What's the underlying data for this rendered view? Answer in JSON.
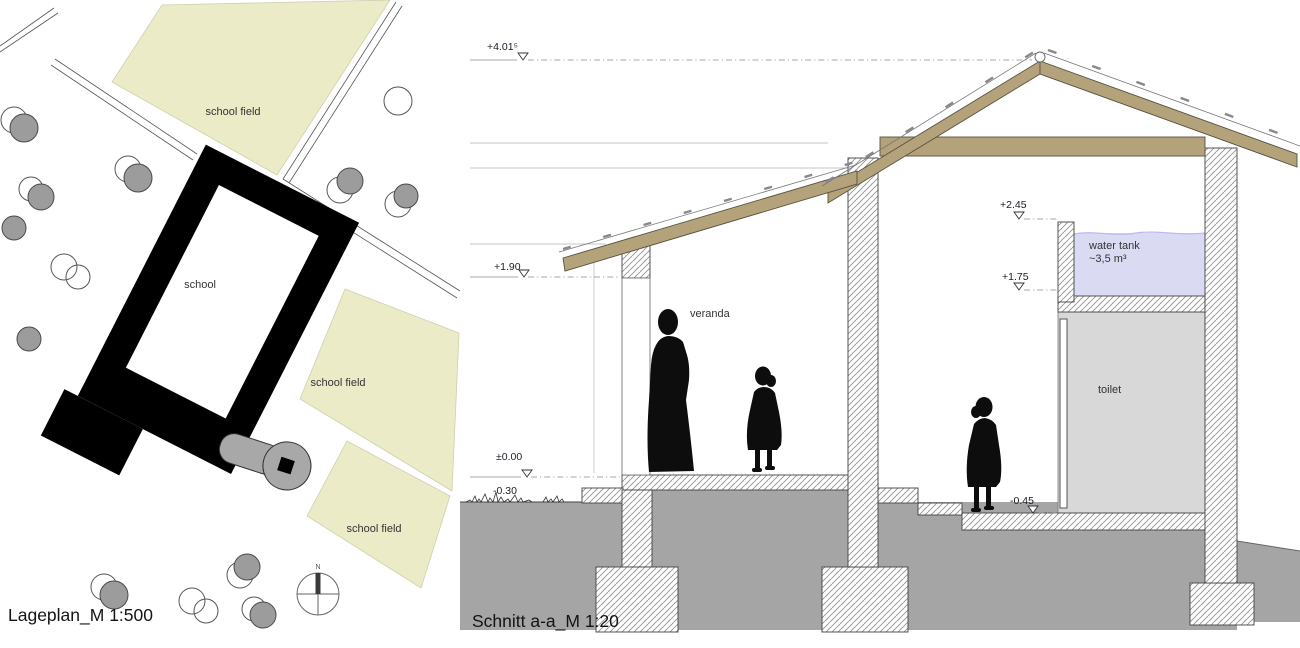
{
  "site_plan": {
    "title": "Lageplan_M 1:500",
    "building_label": "school",
    "field_labels": [
      "school field",
      "school field",
      "school field"
    ],
    "compass_north_label": "N",
    "colors": {
      "field": "#ecebc7",
      "tree": "#9c9c9c",
      "building": "#000000",
      "key": "#a8a8a8"
    }
  },
  "section": {
    "title": "Schnitt a-a_M 1:20",
    "labels": {
      "veranda": "veranda",
      "toilet": "toilet",
      "water_tank": "water tank",
      "water_tank_volume": "~3,5 m³"
    },
    "levels": {
      "ridge": "+4.01⁵",
      "veranda_eave": "+1.90",
      "floor": "±0.00",
      "terrain": "-0.30",
      "tank_top": "+2.45",
      "tank_bottom": "+1.75",
      "yard": "-0.45"
    },
    "colors": {
      "wood": "#b3a27a",
      "earth": "#a5a5a5",
      "water": "#dadbf2",
      "toilet_room": "#d8d8d8"
    }
  }
}
